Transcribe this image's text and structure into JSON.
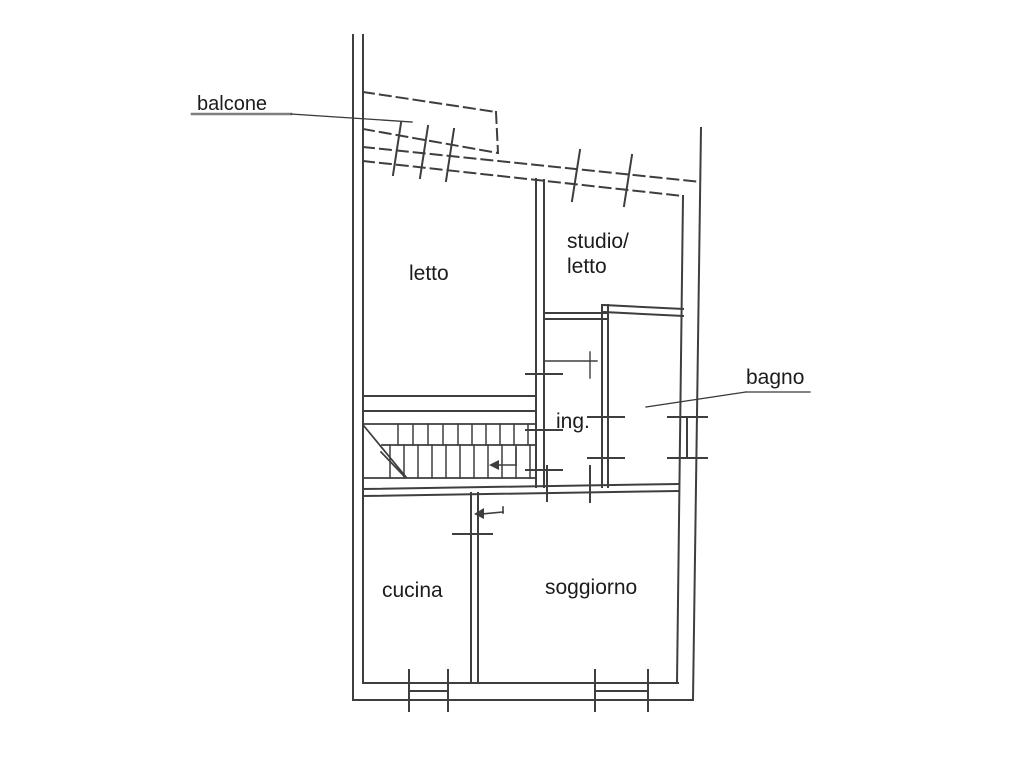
{
  "plan": {
    "type": "apartment-floor-plan",
    "labels": {
      "balcone": "balcone",
      "letto": "letto",
      "studio_letto": "studio/\nletto",
      "ing": "ing.",
      "bagno": "bagno",
      "cucina": "cucina",
      "soggiorno": "soggiorno"
    },
    "colors": {
      "line": "#3e3e3e",
      "background": "#ffffff",
      "text": "#1c1c1c"
    }
  }
}
